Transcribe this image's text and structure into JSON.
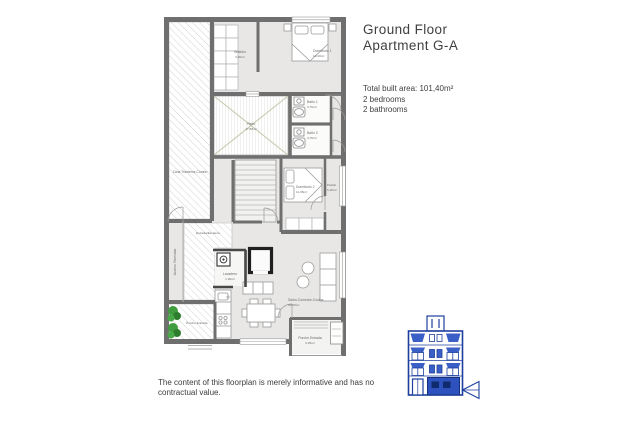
{
  "header": {
    "line1": "Ground Floor",
    "line2": "Apartment G-A"
  },
  "summary": {
    "area": "Total built area: 101,40m²",
    "bedrooms": "2 bedrooms",
    "bathrooms": "2 bathrooms"
  },
  "disclaimer": "The content of this floorplan is merely informative and has no contractual value.",
  "plan": {
    "rooms": {
      "trasteros": {
        "name": "Zona Trasteros Común"
      },
      "acceso": {
        "name": "Acceso Viviendas"
      },
      "entrada": {
        "name": "Entrada/Escalera"
      },
      "vestidor": {
        "name": "Vestidor",
        "area": "3,90m²"
      },
      "dormitorio1": {
        "name": "Dormitorio 1",
        "area": "12,40m²"
      },
      "patio": {
        "name": "Patio",
        "area": "17,80m²"
      },
      "bano1": {
        "name": "Baño 1",
        "area": "3,70m²"
      },
      "bano2": {
        "name": "Baño 2",
        "area": "3,70m²"
      },
      "pasillo": {
        "name": "Pasillo",
        "area": "5,20m²"
      },
      "dormitorio2": {
        "name": "Dormitorio 2",
        "area": "11,05m²"
      },
      "lavadero": {
        "name": "Lavadero",
        "area": "1,90m²"
      },
      "salon": {
        "name": "Salón-Comedor-Cocina",
        "area": "32,50m²"
      },
      "porche_left": {
        "name": "Porche Entrada"
      },
      "porche_right": {
        "name": "Porche Entrada",
        "area": "3,25m²"
      }
    },
    "colors": {
      "wall": "#6f6f6f",
      "floor": "#e8e7e5",
      "hatch_line": "#c6c6c6",
      "patio_cross": "#c6c9b0",
      "plant_green": "#3f9d3f",
      "elevation_outline": "#1d3f9e",
      "elevation_fill": "#3a5fc6",
      "text_dark": "#3f3f3f",
      "label_gray": "#6b6b6b"
    }
  }
}
